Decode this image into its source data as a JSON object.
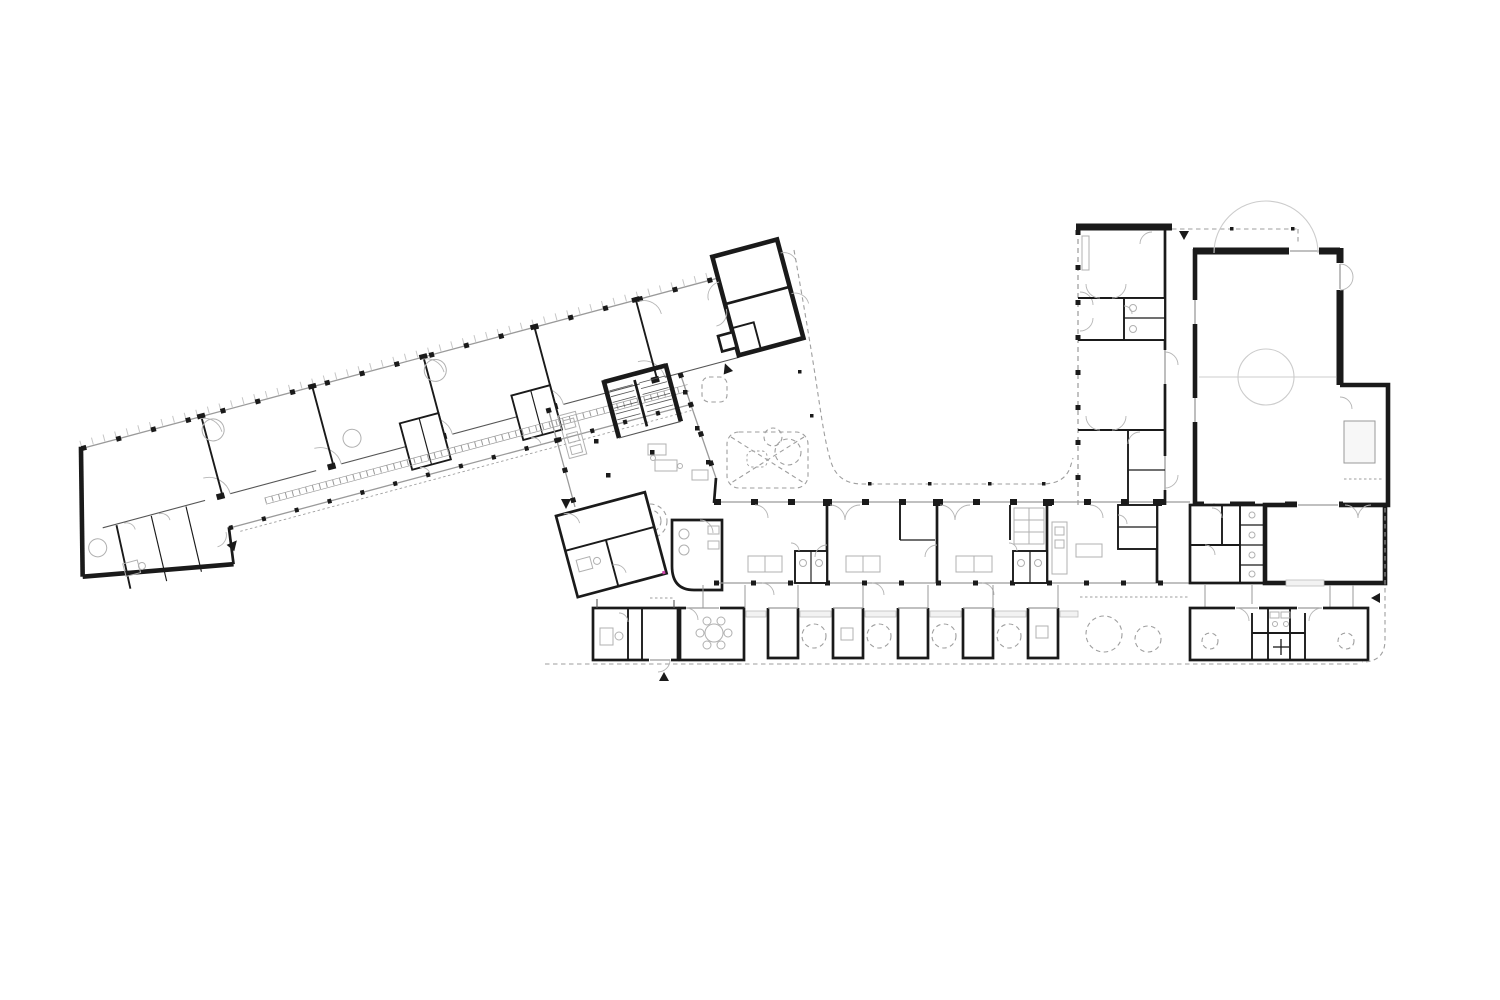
{
  "canvas": {
    "width": 1500,
    "height": 1000,
    "background": "#ffffff"
  },
  "colors": {
    "wall": "#1a1a1a",
    "glazing": "#9a9a9a",
    "furniture": "#b0b0b0",
    "dashed_outline": "#9e9e9e",
    "court_markings": "#cccccc",
    "roof_ticks": "#c6c6c6",
    "accent_mark": "#cc44aa",
    "sill_fill": "#f2f2f2",
    "equipment_fill": "#f7f7f7"
  },
  "drawing": {
    "kind": "architectural-ground-floor-plan",
    "wings": [
      {
        "name": "west-classroom-wing",
        "rotation_deg": -15,
        "classrooms": 5,
        "end_block_rooms": 2,
        "corridor": true
      },
      {
        "name": "central-entrance-hall",
        "features": [
          "stair",
          "kitchen-counter",
          "wc-cluster",
          "staff-suite"
        ]
      },
      {
        "name": "south-classroom-wing",
        "classrooms": 3,
        "kitchen": true,
        "wc_pairs": 2
      },
      {
        "name": "north-room-wing",
        "rooms": 5
      },
      {
        "name": "sports-hall",
        "court_markings": [
          "center-circle",
          "center-line",
          "goal-arcs"
        ],
        "annex": true
      },
      {
        "name": "south-east-block",
        "rooms": 4
      }
    ],
    "pavilions": {
      "count": 9,
      "row": "south-covered-walkway"
    },
    "courtyard": {
      "play_feature": "crossed-sandbox",
      "dashed_trees": 8,
      "canopy_columns": 8
    },
    "entrance_arrows": 6
  }
}
